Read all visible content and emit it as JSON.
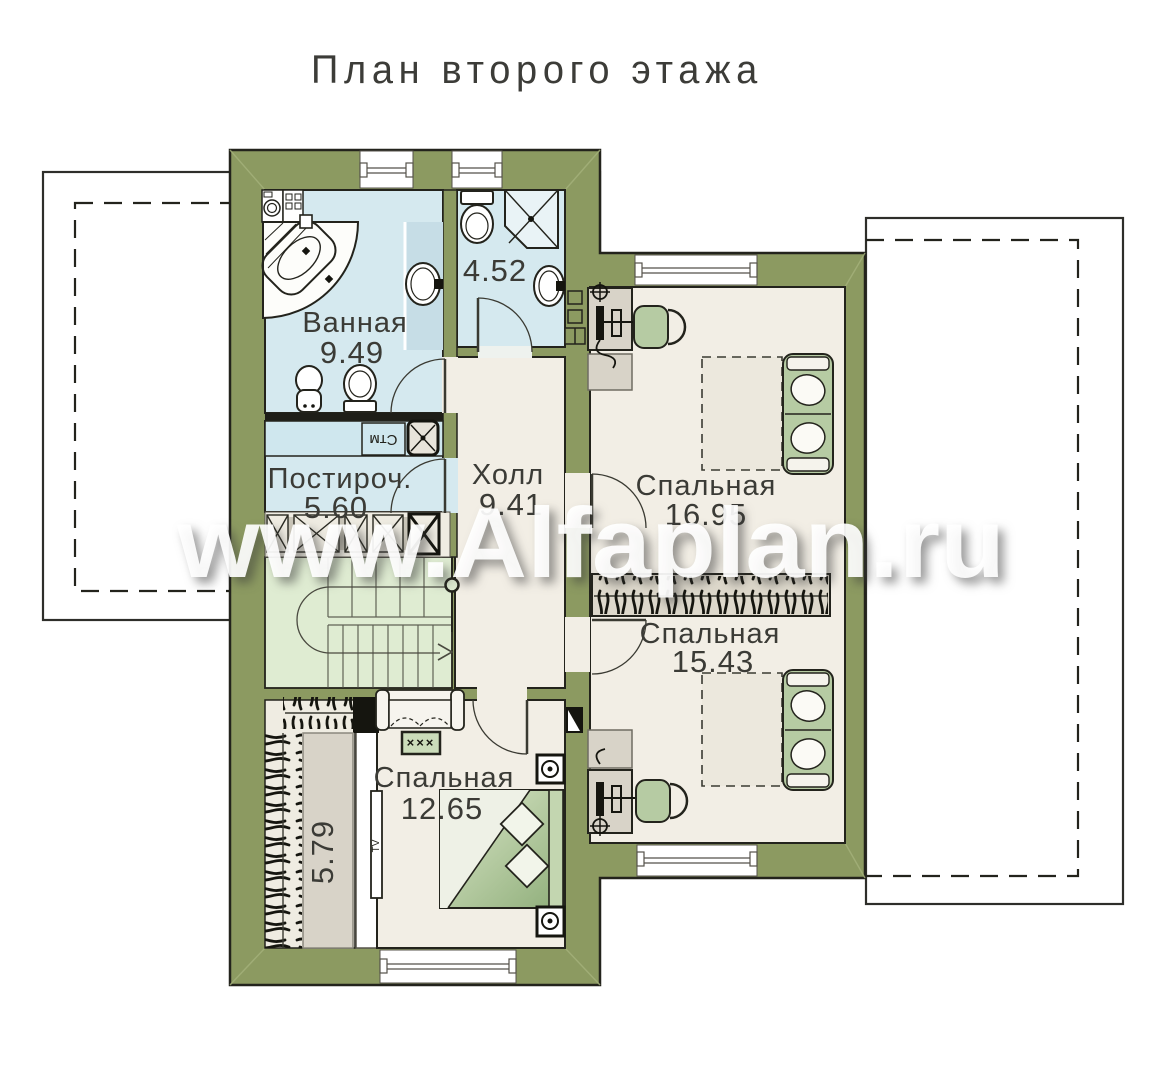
{
  "title": "План второго этажа",
  "watermark": "www.Alfaplan.ru",
  "rooms": {
    "bathroom": {
      "name": "Ванная",
      "area": "9.49"
    },
    "wc": {
      "area": "4.52"
    },
    "laundry": {
      "name": "Постироч.",
      "area": "5.60"
    },
    "hall": {
      "name": "Холл",
      "area": "9.41"
    },
    "bedroom_top": {
      "name": "Спальная",
      "area": "16.95"
    },
    "bedroom_right": {
      "name": "Спальная",
      "area": "15.43"
    },
    "bedroom_bottom": {
      "name": "Спальная",
      "area": "12.65"
    },
    "wardrobe": {
      "area": "5.79"
    }
  },
  "fixtures": {
    "washing_machine": "Стм",
    "tv": "TV",
    "speakers": "×××"
  },
  "colors": {
    "wall": "#8c9a61",
    "wet_room": "#d5e9ef",
    "room": "#f2eee5",
    "stairs": "#dfecd2",
    "closet": "#efece2",
    "furniture_green": "#b6cba3",
    "outline": "#23231c"
  }
}
